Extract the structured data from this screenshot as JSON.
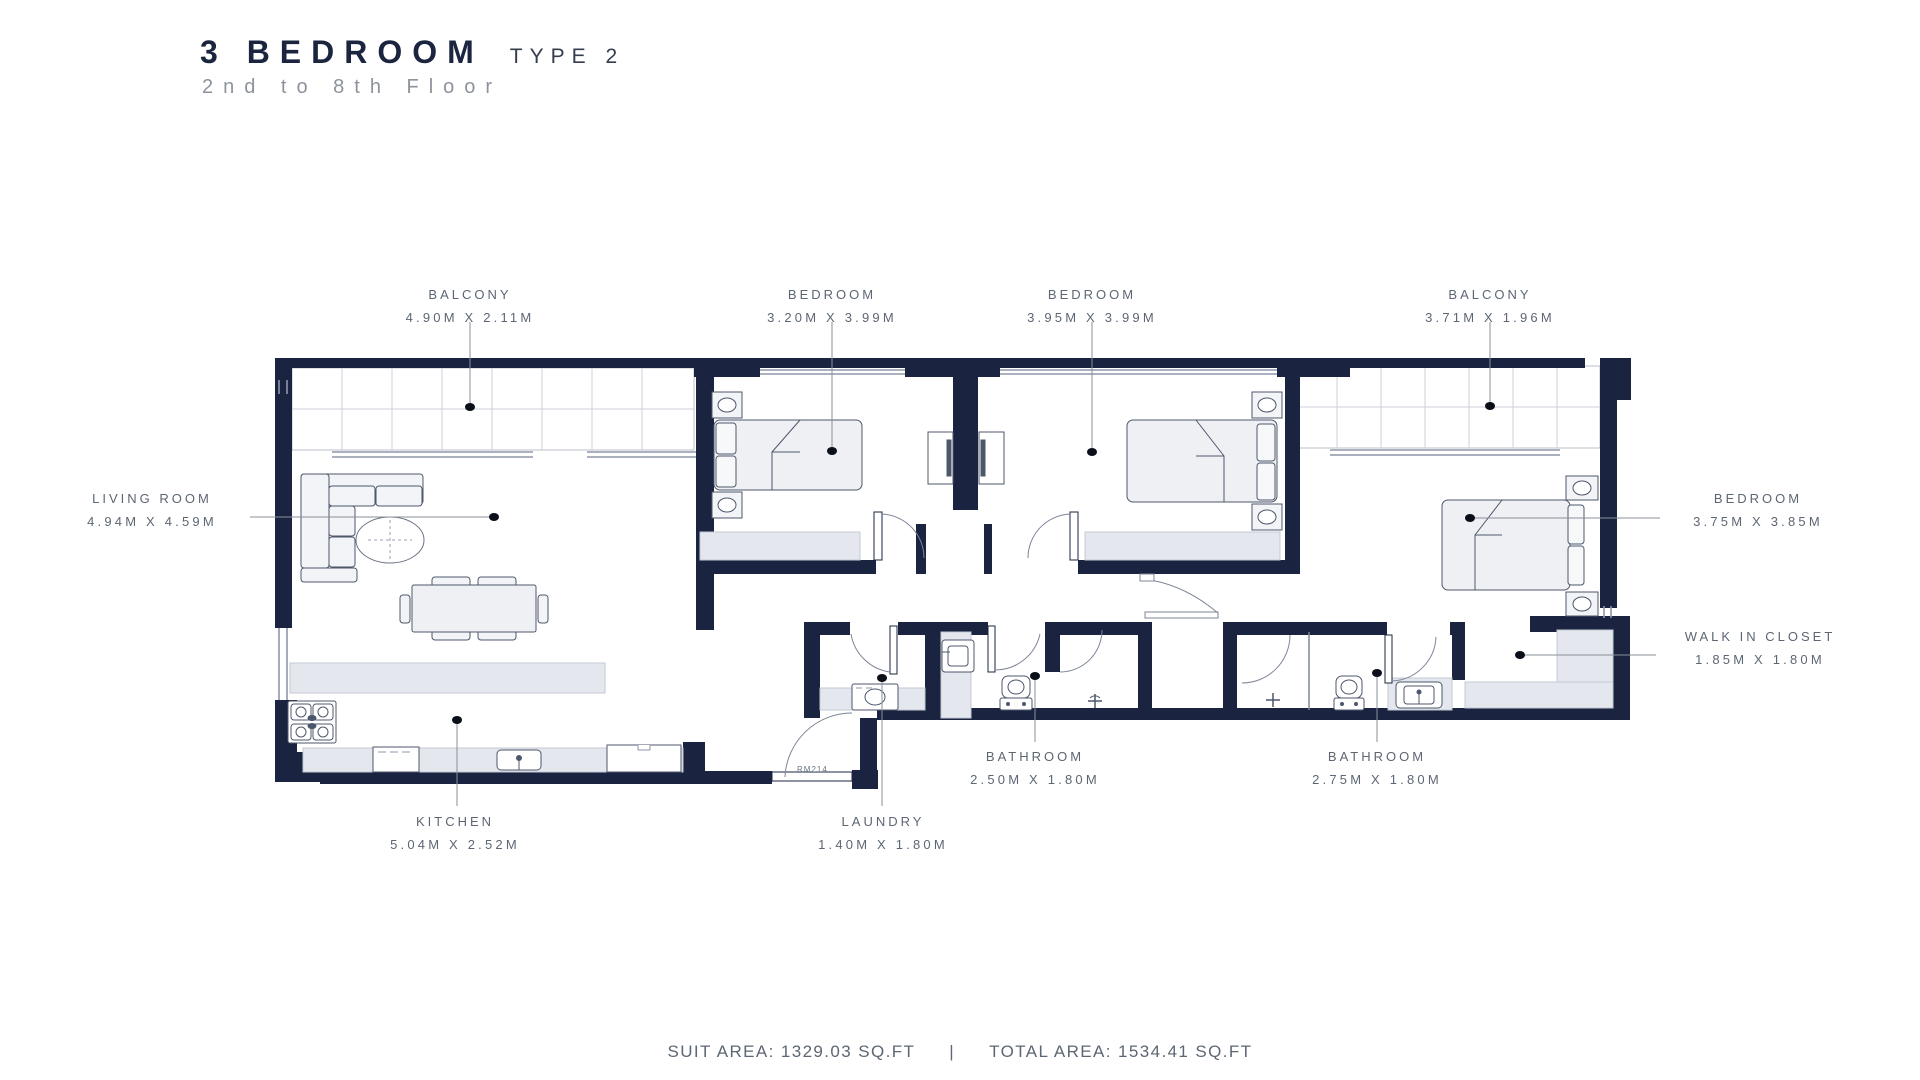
{
  "title": {
    "main": "3 BEDROOM",
    "type": "TYPE 2",
    "subtitle": "2nd to 8th Floor"
  },
  "rooms": {
    "balcony1": {
      "name": "BALCONY",
      "dims": "4.90M X 2.11M"
    },
    "bedroom1": {
      "name": "BEDROOM",
      "dims": "3.20M X 3.99M"
    },
    "bedroom2": {
      "name": "BEDROOM",
      "dims": "3.95M X 3.99M"
    },
    "balcony2": {
      "name": "BALCONY",
      "dims": "3.71M X 1.96M"
    },
    "living": {
      "name": "LIVING ROOM",
      "dims": "4.94M X 4.59M"
    },
    "bedroom3": {
      "name": "BEDROOM",
      "dims": "3.75M X 3.85M"
    },
    "wic": {
      "name": "WALK IN CLOSET",
      "dims": "1.85M X 1.80M"
    },
    "bathroom1": {
      "name": "BATHROOM",
      "dims": "2.50M X 1.80M"
    },
    "bathroom2": {
      "name": "BATHROOM",
      "dims": "2.75M X 1.80M"
    },
    "kitchen": {
      "name": "KITCHEN",
      "dims": "5.04M X 2.52M"
    },
    "laundry": {
      "name": "LAUNDRY",
      "dims": "1.40M X 1.80M"
    }
  },
  "door_tag": "RM214",
  "footer": {
    "suit_area": "SUIT AREA: 1329.03 SQ.FT",
    "separator": "|",
    "total_area": "TOTAL AREA: 1534.41 SQ.FT"
  },
  "colors": {
    "wall": "#1a2440",
    "label_text": "#5d6673",
    "accent_gray": "#e4e7ed"
  }
}
